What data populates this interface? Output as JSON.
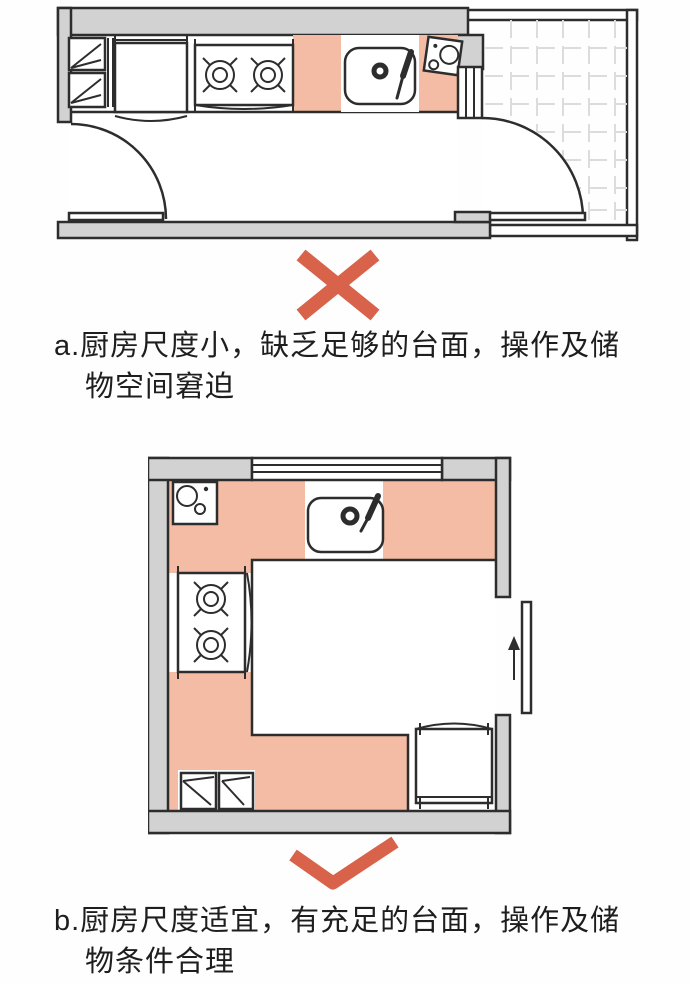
{
  "colors": {
    "bg": "#fefefe",
    "ink": "#2d2d2d",
    "wall": "#d2d2d2",
    "counter": "#f4bca4",
    "tile": "#dcdcdc",
    "mark": "#d8624a",
    "text": "#1e1e1e"
  },
  "marks": {
    "a": "cross-icon",
    "b": "check-icon"
  },
  "captions": {
    "a": {
      "line1": "a.厨房尺度小，缺乏足够的台面，操作及储",
      "line2": "物空间窘迫"
    },
    "b": {
      "line1": "b.厨房尺度适宜，有充足的台面，操作及储",
      "line2": "物条件合理"
    }
  }
}
